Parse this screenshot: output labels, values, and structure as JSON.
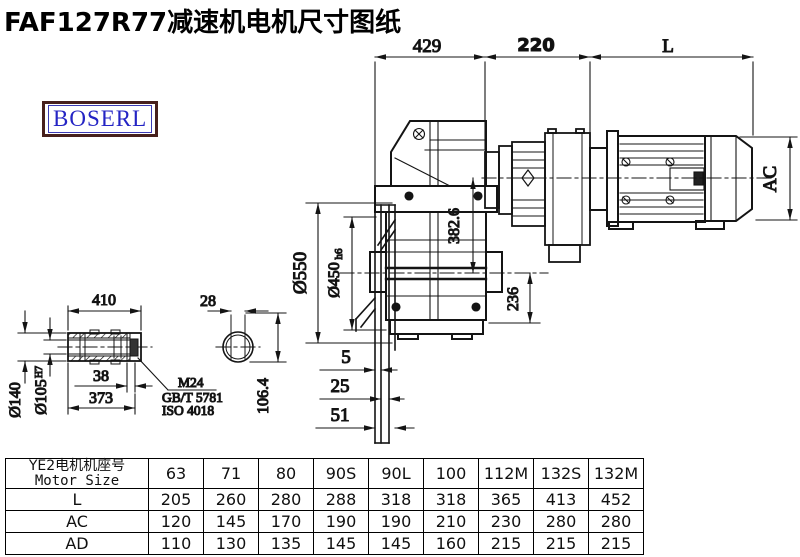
{
  "title": "FAF127R77减速机电机尺寸图纸",
  "logo": {
    "text": "BOSERL",
    "text_color": "#2424c4",
    "border_color": "#46201c"
  },
  "drawing": {
    "line_color": "#141414",
    "dims": {
      "top_left": "429",
      "top_mid": "220",
      "top_right": "L",
      "motor_height": "AC",
      "center_height": "382.6",
      "output_bottom": "236",
      "flange_od": "Ø550",
      "spigot_d": "Ø450",
      "spigot_tol": "h6",
      "offset_1": "5",
      "offset_2": "25",
      "offset_3": "51",
      "shaft_len": "410",
      "shaft_od": "Ø140",
      "shaft_bore": "Ø105",
      "shaft_bore_tol": "H7",
      "end_gap": "38",
      "shaft_len2": "373",
      "callout_1": "M24",
      "callout_2": "GB/T 5781",
      "callout_3": "ISO 4018",
      "key_width": "28",
      "key_depth": "106.4"
    }
  },
  "table": {
    "header_cn": "YE2电机机座号",
    "header_en": "Motor Size",
    "columns": [
      "63",
      "71",
      "80",
      "90S",
      "90L",
      "100",
      "112M",
      "132S",
      "132M"
    ],
    "rows": [
      {
        "label": "L",
        "values": [
          "205",
          "260",
          "280",
          "288",
          "318",
          "318",
          "365",
          "413",
          "452"
        ]
      },
      {
        "label": "AC",
        "values": [
          "120",
          "145",
          "170",
          "190",
          "190",
          "210",
          "230",
          "280",
          "280"
        ]
      },
      {
        "label": "AD",
        "values": [
          "110",
          "130",
          "135",
          "145",
          "145",
          "160",
          "215",
          "215",
          "215"
        ]
      }
    ]
  }
}
